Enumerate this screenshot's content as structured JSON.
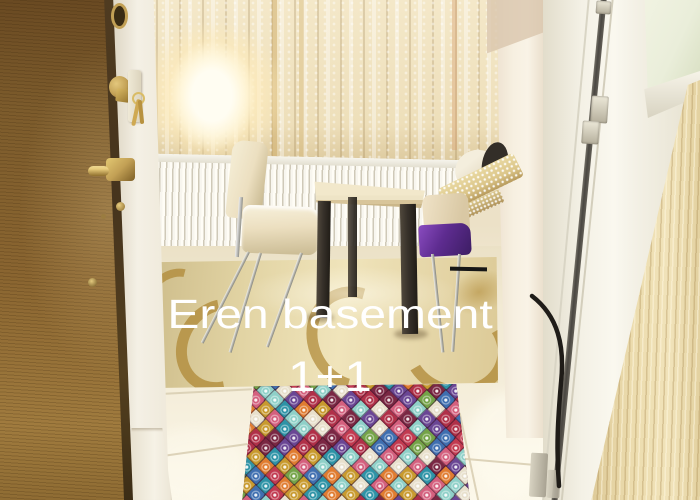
{
  "photo": {
    "overlay_text": {
      "line1": "Eren basement",
      "line2": "1+1"
    }
  },
  "colors": {
    "door_brown_dark": "#6a4a22",
    "door_brown": "#8a6530",
    "door_brown_light": "#a07b3e",
    "door_edge": "#46341d",
    "brass": "#c2a055",
    "brass_dark": "#7d5f26",
    "jamb_white": "#f4f0e5",
    "curtain_cream": "#f4e8c9",
    "curtain_shadow": "#d6c193",
    "curtain_gold": "#c9a55b",
    "lamp_core": "#fffdf2",
    "lamp_glow": "#ffedbe",
    "wall_cream": "#ede2c9",
    "wall_column": "#f7f0e1",
    "soffit": "#d9c6ad",
    "radiator_white": "#f8f6ef",
    "radiator_shadow": "#cfc9b8",
    "table_top": "#eee4c6",
    "table_leg": "#37312a",
    "chair_cream": "#ecdfc0",
    "chair_shadow": "#c9ba92",
    "chrome": "#c2c1b8",
    "purple_seat": "#5e2c90",
    "sequin_gold": "#dcc68a",
    "pillow": "#f4eedd",
    "cushion_dark": "#332e28",
    "pvc_white": "#f3f0e5",
    "pvc_shadow": "#d9d5c5",
    "frame_gap": "#3b3833",
    "glass": "#eaeeda",
    "wood_light": "#ecdcae",
    "wood_shadow": "#d9c491",
    "tile": "#f2ead4",
    "tile_bright": "#fcf8ea",
    "grout": "#d7ccb0",
    "gold_rug": "#e2d4a4",
    "gold_rug_motif": "#b28d3c",
    "rug_dark": "#4a2133",
    "caption_white": "#ffffff",
    "mark_black": "#161616",
    "rug_palette": [
      "#c23a50",
      "#2e93a6",
      "#e8e0cc",
      "#7a2743",
      "#74a348",
      "#e07c30",
      "#d4607e",
      "#6a4694",
      "#3f6fb0",
      "#c89a2e",
      "#8fd0c8",
      "#b03048"
    ]
  }
}
